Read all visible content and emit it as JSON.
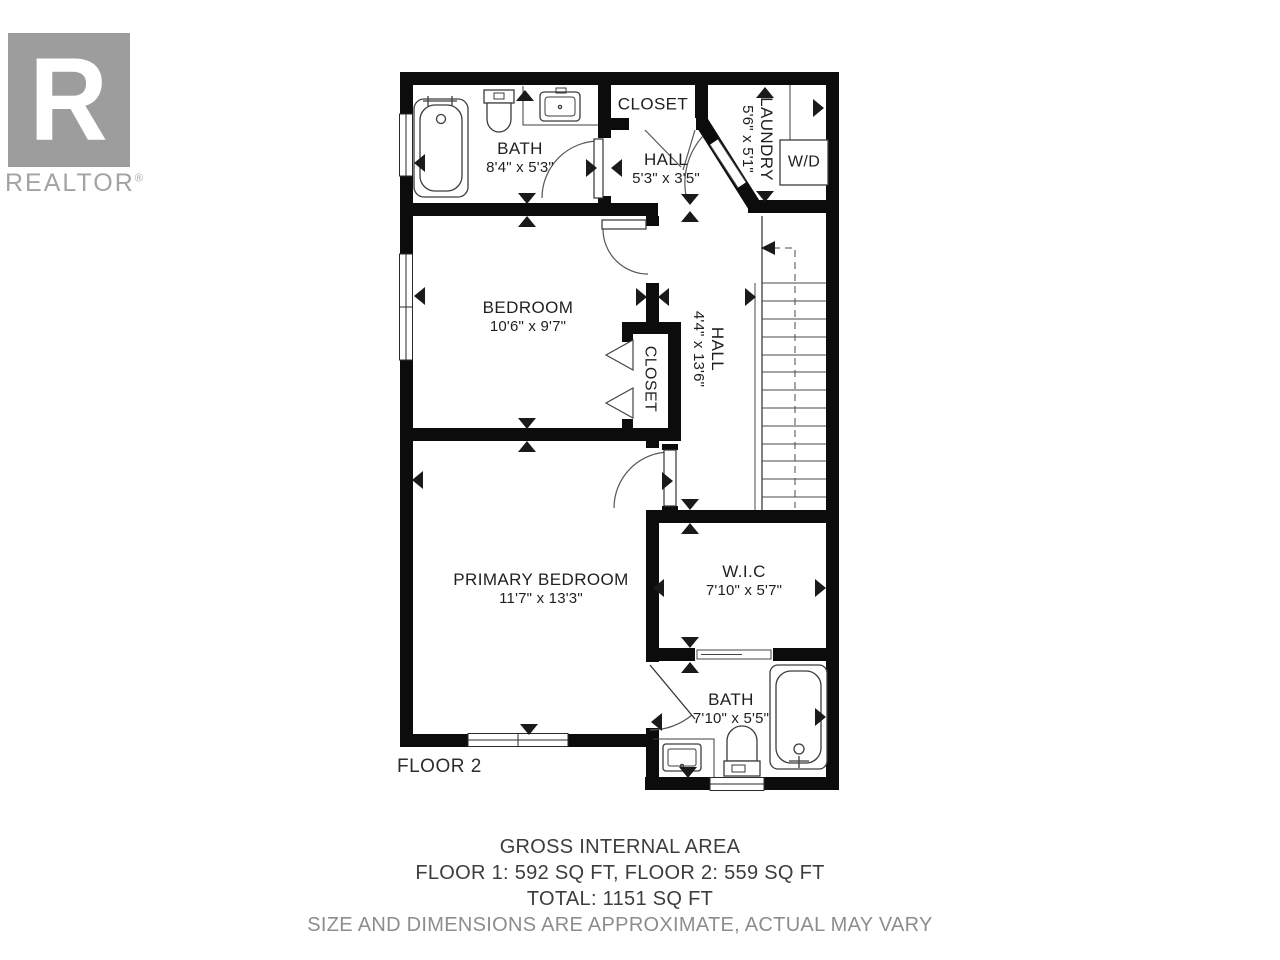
{
  "branding": {
    "logo_letter": "R",
    "logo_text": "REALTOR",
    "registered": "®"
  },
  "floor_label": "FLOOR 2",
  "rooms": {
    "bath2": {
      "name": "BATH",
      "dims": "8'4\" x 5'3\""
    },
    "closet_top": {
      "name": "CLOSET"
    },
    "hall_top": {
      "name": "HALL",
      "dims": "5'3\" x 3'5\""
    },
    "laundry": {
      "name": "LAUNDRY",
      "dims": "5'6\" x 5'1\""
    },
    "bedroom": {
      "name": "BEDROOM",
      "dims": "10'6\" x 9'7\""
    },
    "closet_mid": {
      "name": "CLOSET"
    },
    "hall_main": {
      "name": "HALL",
      "dims": "4'4\" x 13'6\""
    },
    "primary": {
      "name": "PRIMARY BEDROOM",
      "dims": "11'7\" x 13'3\""
    },
    "wic": {
      "name": "W.I.C",
      "dims": "7'10\" x 5'7\""
    },
    "bath_ensuite": {
      "name": "BATH",
      "dims": "7'10\" x 5'5\""
    }
  },
  "appliances": {
    "washer_dryer": "W/D"
  },
  "footer": {
    "gross_title": "GROSS INTERNAL AREA",
    "floors_line": "FLOOR 1: 592 SQ FT, FLOOR 2: 559 SQ FT",
    "total_line": "TOTAL: 1151 SQ FT",
    "disclaimer": "SIZE AND DIMENSIONS ARE APPROXIMATE, ACTUAL MAY VARY"
  },
  "colors": {
    "wall": "#0c0c0c",
    "label": "#1f1f1f",
    "muted_text": "#8d8d8d",
    "logo_gray": "#9d9d9d"
  }
}
